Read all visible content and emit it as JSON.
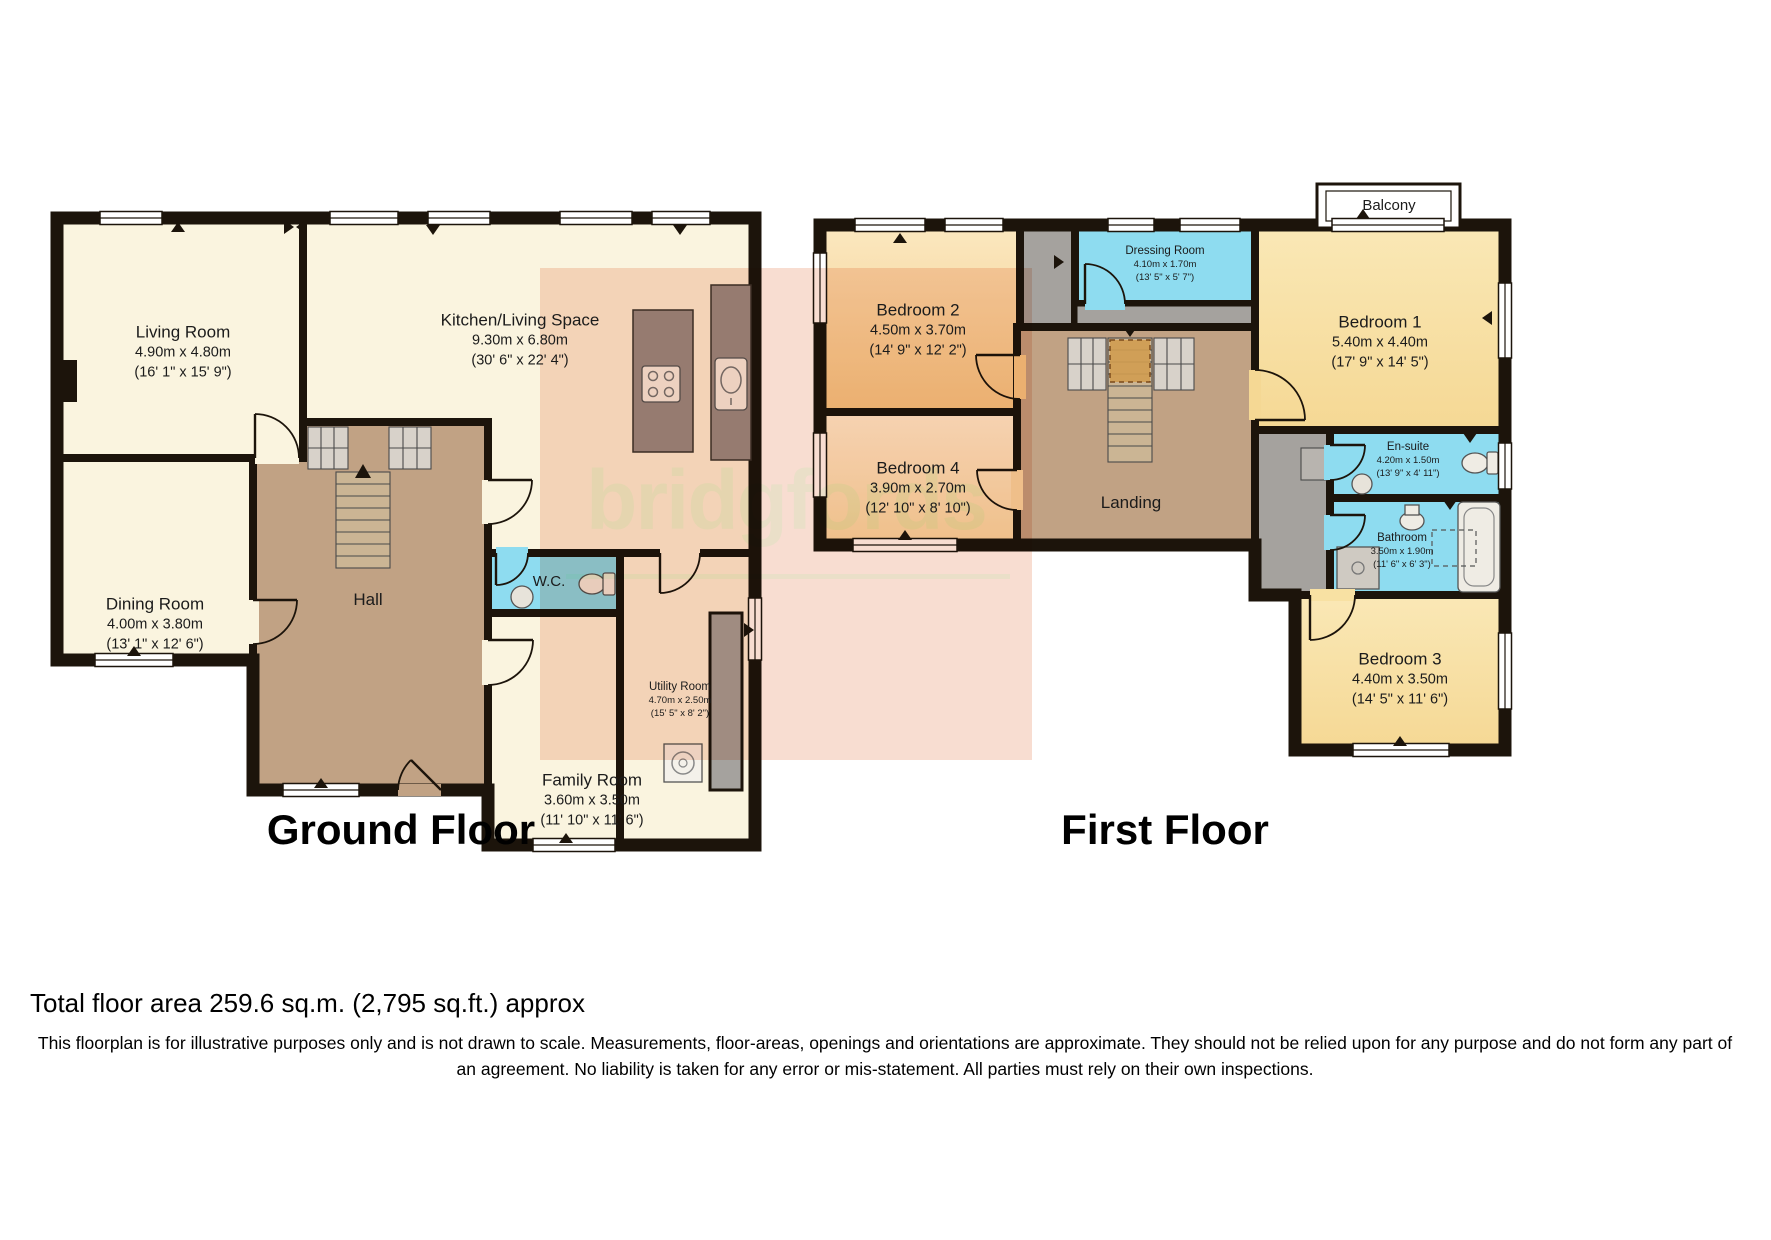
{
  "ground_floor": {
    "heading": "Ground Floor",
    "rooms": {
      "living": {
        "name": "Living Room",
        "dims_m": "4.90m x 4.80m",
        "dims_ft": "(16' 1\" x 15' 9\")"
      },
      "kitchen": {
        "name": "Kitchen/Living Space",
        "dims_m": "9.30m x 6.80m",
        "dims_ft": "(30' 6\" x 22' 4\")"
      },
      "dining": {
        "name": "Dining Room",
        "dims_m": "4.00m x 3.80m",
        "dims_ft": "(13' 1\" x 12' 6\")"
      },
      "hall": {
        "name": "Hall"
      },
      "wc": {
        "name": "W.C."
      },
      "utility": {
        "name": "Utility Room",
        "dims_m": "4.70m x 2.50m",
        "dims_ft": "(15' 5\" x 8' 2\")"
      },
      "family": {
        "name": "Family Room",
        "dims_m": "3.60m x 3.50m",
        "dims_ft": "(11' 10\" x 11' 6\")"
      }
    }
  },
  "first_floor": {
    "heading": "First Floor",
    "rooms": {
      "bedroom1": {
        "name": "Bedroom 1",
        "dims_m": "5.40m x 4.40m",
        "dims_ft": "(17' 9\" x 14' 5\")"
      },
      "bedroom2": {
        "name": "Bedroom 2",
        "dims_m": "4.50m x 3.70m",
        "dims_ft": "(14' 9\" x 12' 2\")"
      },
      "bedroom3": {
        "name": "Bedroom 3",
        "dims_m": "4.40m x 3.50m",
        "dims_ft": "(14' 5\" x 11' 6\")"
      },
      "bedroom4": {
        "name": "Bedroom 4",
        "dims_m": "3.90m x 2.70m",
        "dims_ft": "(12' 10\" x 8' 10\")"
      },
      "dressing": {
        "name": "Dressing Room",
        "dims_m": "4.10m x 1.70m",
        "dims_ft": "(13' 5\" x 5' 7\")"
      },
      "landing": {
        "name": "Landing"
      },
      "ensuite": {
        "name": "En-suite",
        "dims_m": "4.20m x 1.50m",
        "dims_ft": "(13' 9\" x 4' 11\")"
      },
      "bathroom": {
        "name": "Bathroom",
        "dims_m": "3.50m x 1.90m",
        "dims_ft": "(11' 6\" x 6' 3\")"
      },
      "balcony": {
        "name": "Balcony"
      }
    }
  },
  "watermark": {
    "text": "bridgfords"
  },
  "footer": {
    "area": "Total floor area 259.6 sq.m. (2,795 sq.ft.) approx",
    "disclaimer": "This floorplan is for illustrative purposes only and is not drawn to scale. Measurements, floor-areas, openings and orientations are approximate. They should not be relied upon for any purpose and do not form any part of an agreement. No liability is taken for any error or mis-statement. All parties must rely on their own inspections."
  },
  "colors": {
    "floor_cream": "#faf4df",
    "floor_tan": "#c1a284",
    "floor_blue": "#8edcf0",
    "floor_orange": "#f5d292",
    "floor_yellow": "#f8e1a3",
    "corridor_gray": "#a5a29e",
    "wall": "#1c140b",
    "watermark_pink": "#f8ddd1"
  }
}
